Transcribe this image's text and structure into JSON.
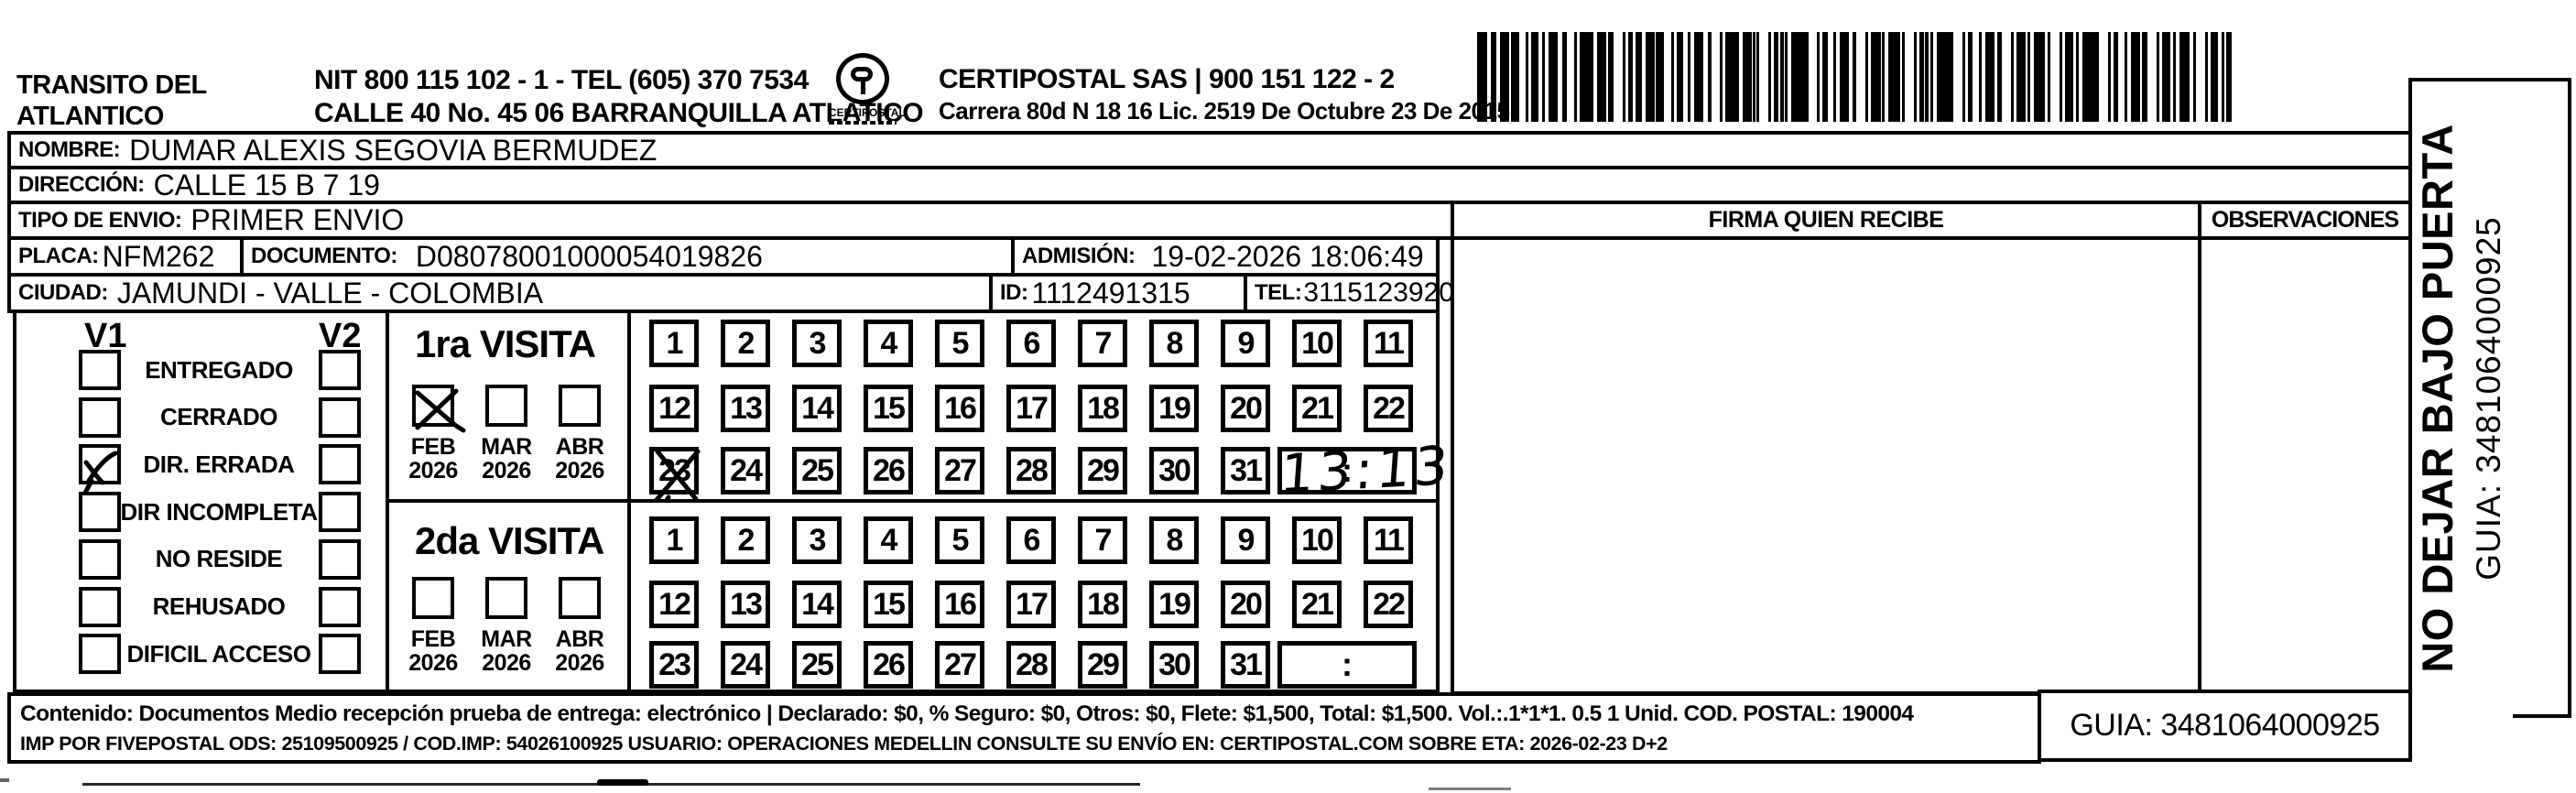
{
  "header": {
    "sender_name_line1": "TRANSITO DEL",
    "sender_name_line2": "ATLANTICO",
    "nit_line": "NIT 800 115 102 - 1 - TEL (605) 370 7534",
    "address_line": "CALLE 40 No. 45 06 BARRANQUILLA ATLATICO",
    "logo_text": "CERTIPOSTAL",
    "company_line": "CERTIPOSTAL SAS | 900 151 122 - 2",
    "license_line": "Carrera 80d N 18 16  Lic. 2519 De Octubre 23 De 2015"
  },
  "recipient": {
    "nombre_label": "NOMBRE:",
    "nombre": "DUMAR ALEXIS SEGOVIA BERMUDEZ",
    "direccion_label": "DIRECCIÓN:",
    "direccion": "CALLE 15 B 7 19",
    "tipo_envio_label": "TIPO DE ENVIO:",
    "tipo_envio": "PRIMER ENVIO",
    "placa_label": "PLACA:",
    "placa": "NFM262",
    "documento_label": "DOCUMENTO:",
    "documento": "D08078001000054019826",
    "admision_label": "ADMISIÓN:",
    "admision": "19-02-2026 18:06:49",
    "ciudad_label": "CIUDAD:",
    "ciudad": "JAMUNDI - VALLE - COLOMBIA",
    "id_label": "ID:",
    "id": "1112491315",
    "tel_label": "TEL:",
    "tel": "3115123920"
  },
  "signature": {
    "firma_header": "FIRMA QUIEN RECIBE",
    "observaciones_header": "OBSERVACIONES"
  },
  "status_panel": {
    "col1_header": "V1",
    "col2_header": "V2",
    "options": [
      "ENTREGADO",
      "CERRADO",
      "DIR. ERRADA",
      "DIR INCOMPLETA",
      "NO RESIDE",
      "REHUSADO",
      "DIFICIL ACCESO"
    ],
    "v1_checked_option": "DIR. ERRADA",
    "v2_checked_option": ""
  },
  "day_numbers": [
    "1",
    "2",
    "3",
    "4",
    "5",
    "6",
    "7",
    "8",
    "9",
    "10",
    "11",
    "12",
    "13",
    "14",
    "15",
    "16",
    "17",
    "18",
    "19",
    "20",
    "21",
    "22",
    "23",
    "24",
    "25",
    "26",
    "27",
    "28",
    "29",
    "30",
    "31"
  ],
  "visits": {
    "first": {
      "title": "1ra VISITA",
      "months": [
        {
          "label": "FEB",
          "year": "2026",
          "checked": true
        },
        {
          "label": "MAR",
          "year": "2026",
          "checked": false
        },
        {
          "label": "ABR",
          "year": "2026",
          "checked": false
        }
      ],
      "crossed_day": "23",
      "time_written": "13:13",
      "time_placeholder": ":"
    },
    "second": {
      "title": "2da VISITA",
      "months": [
        {
          "label": "FEB",
          "year": "2026",
          "checked": false
        },
        {
          "label": "MAR",
          "year": "2026",
          "checked": false
        },
        {
          "label": "ABR",
          "year": "2026",
          "checked": false
        }
      ],
      "crossed_day": "",
      "time_written": "",
      "time_placeholder": ":"
    }
  },
  "side_strip": {
    "warning": "NO DEJAR BAJO PUERTA",
    "guia": "GUIA: 3481064000925"
  },
  "footer": {
    "line1": "Contenido: Documentos Medio recepción prueba de entrega: electrónico | Declarado: $0, % Seguro: $0, Otros: $0, Flete: $1,500, Total: $1,500. Vol.:.1*1*1. 0.5  1 Unid. COD. POSTAL: 190004",
    "line2": "IMP POR FIVEPOSTAL ODS: 25109500925 / COD.IMP: 54026100925 USUARIO: OPERACIONES MEDELLIN CONSULTE SU ENVÍO EN: CERTIPOSTAL.COM SOBRE ETA: 2026-02-23 D+2",
    "guia_box": "GUIA: 3481064000925"
  }
}
